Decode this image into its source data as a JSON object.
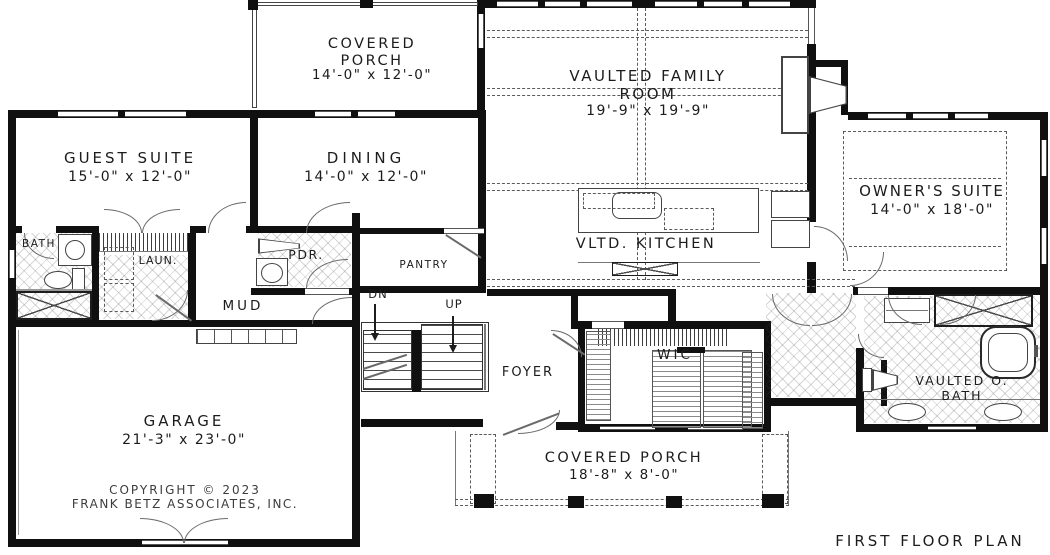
{
  "plan": {
    "title": "FIRST FLOOR PLAN",
    "copyright_line1": "COPYRIGHT © 2023",
    "copyright_line2": "FRANK BETZ ASSOCIATES, INC."
  },
  "rooms": {
    "covered_porch_top": {
      "name": "COVERED PORCH",
      "dims": "14'-0\" x 12'-0\""
    },
    "family_room": {
      "name": "VAULTED FAMILY ROOM",
      "dims": "19'-9\" x 19'-9\""
    },
    "guest_suite": {
      "name": "GUEST SUITE",
      "dims": "15'-0\" x 12'-0\""
    },
    "dining": {
      "name": "DINING",
      "dims": "14'-0\" x 12'-0\""
    },
    "owners_suite": {
      "name": "OWNER'S SUITE",
      "dims": "14'-0\" x 18'-0\""
    },
    "kitchen": {
      "name": "VLTD. KITCHEN"
    },
    "bath": {
      "name": "BATH"
    },
    "laundry": {
      "name": "LAUN."
    },
    "powder": {
      "name": "PDR."
    },
    "pantry": {
      "name": "PANTRY"
    },
    "mud": {
      "name": "MUD"
    },
    "foyer": {
      "name": "FOYER"
    },
    "wic": {
      "name": "WIC"
    },
    "owners_bath": {
      "name": "VAULTED O. BATH"
    },
    "garage": {
      "name": "GARAGE",
      "dims": "21'-3\" x 23'-0\""
    },
    "covered_porch_bottom": {
      "name": "COVERED PORCH",
      "dims": "18'-8\" x 8'-0\""
    }
  },
  "stairs": {
    "down_label": "DN",
    "up_label": "UP"
  }
}
